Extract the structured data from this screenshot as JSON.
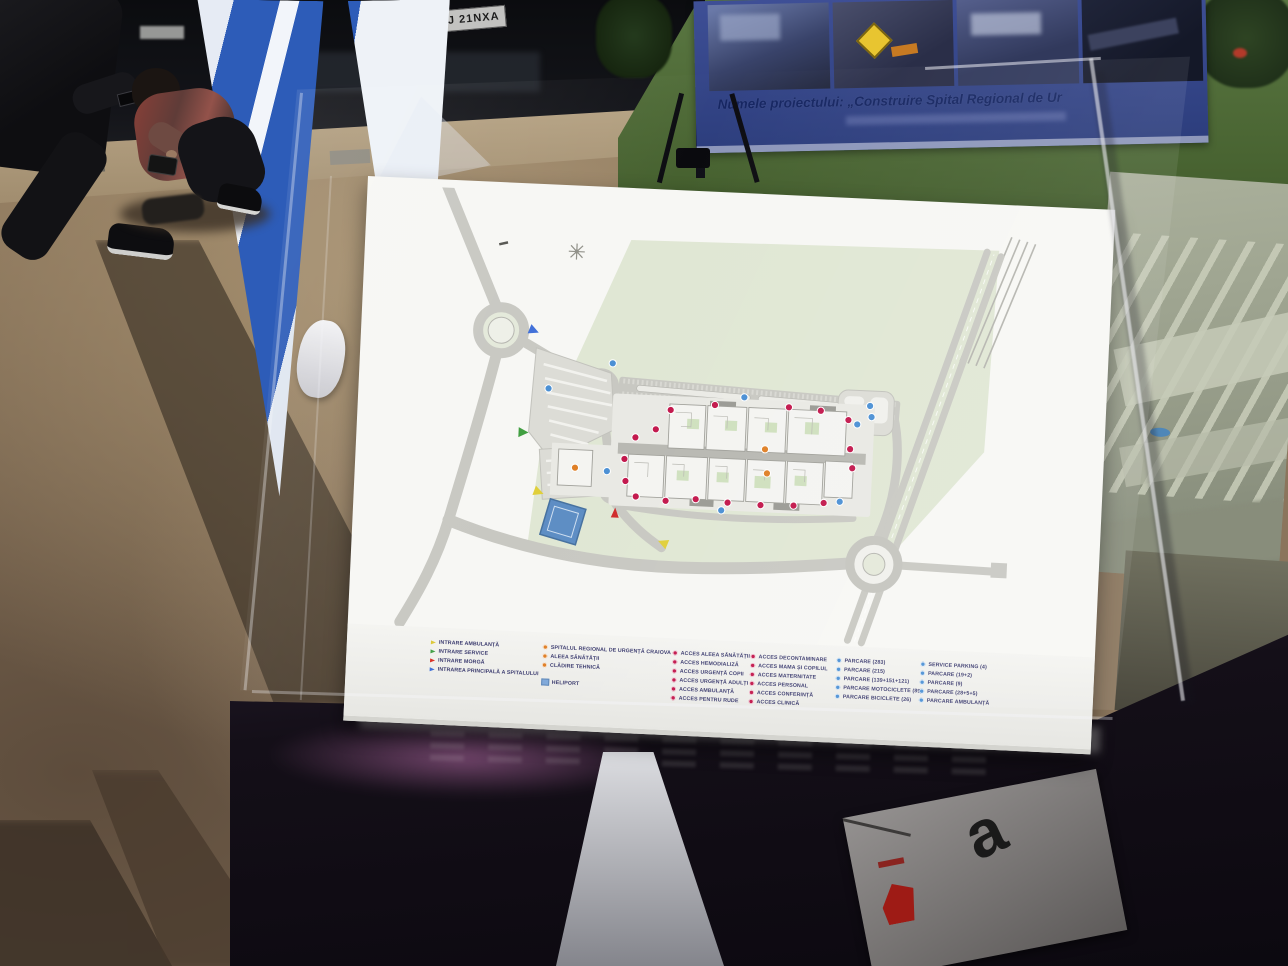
{
  "scene": {
    "truck": {
      "plate": "GJ 21NXA"
    },
    "banner": {
      "title": "Numele proiectului: „Construire Spital Regional de Ur"
    },
    "paper": {
      "letter": "a"
    }
  },
  "board": {
    "legend": {
      "entrances": [
        {
          "marker": "yellow-arrow",
          "label": "INTRARE AMBULANȚĂ"
        },
        {
          "marker": "green-arrow",
          "label": "INTRARE SERVICE"
        },
        {
          "marker": "red-arrow",
          "label": "INTRARE MORGĂ"
        },
        {
          "marker": "blue-arrow",
          "label": "INTRAREA PRINCIPALĂ A SPITALULUI"
        }
      ],
      "places": [
        {
          "marker": "orange-circle",
          "label": "SPITALUL REGIONAL DE URGENȚĂ CRAIOVA"
        },
        {
          "marker": "orange-circle",
          "label": "ALEEA SĂNĂTĂȚII"
        },
        {
          "marker": "orange-circle",
          "label": "CLĂDIRE TEHNICĂ"
        },
        {
          "marker": "blue-square",
          "label": "HELIPORT"
        }
      ],
      "access_a": [
        {
          "marker": "red-circle",
          "label": "ACCES ALEEA SĂNĂTĂȚII"
        },
        {
          "marker": "red-circle",
          "label": "ACCES HEMODIALIZĂ"
        },
        {
          "marker": "red-circle",
          "label": "ACCES URGENȚĂ COPII"
        },
        {
          "marker": "red-circle",
          "label": "ACCES URGENȚĂ ADULȚI"
        },
        {
          "marker": "red-circle",
          "label": "ACCES AMBULANȚĂ"
        },
        {
          "marker": "red-circle",
          "label": "ACCES PENTRU RUDE"
        }
      ],
      "access_b": [
        {
          "marker": "red-circle",
          "label": "ACCES DECONTAMINARE"
        },
        {
          "marker": "red-circle",
          "label": "ACCES MAMA ȘI COPILUL"
        },
        {
          "marker": "red-circle",
          "label": "ACCES MATERNITATE"
        },
        {
          "marker": "red-circle",
          "label": "ACCES PERSONAL"
        },
        {
          "marker": "red-circle",
          "label": "ACCES CONFERINȚĂ"
        },
        {
          "marker": "red-circle",
          "label": "ACCES CLINICĂ"
        }
      ],
      "parking_a": [
        {
          "marker": "blue-circle",
          "label": "PARCARE (283)"
        },
        {
          "marker": "blue-circle",
          "label": "PARCARE (215)"
        },
        {
          "marker": "blue-circle",
          "label": "PARCARE (139+151+121)"
        },
        {
          "marker": "blue-circle",
          "label": "PARCARE MOTOCICLETE (89)"
        },
        {
          "marker": "blue-circle",
          "label": "PARCARE BICICLETE (26)"
        }
      ],
      "parking_b": [
        {
          "marker": "blue-circle",
          "label": "SERVICE PARKING (4)"
        },
        {
          "marker": "blue-circle",
          "label": "PARCARE (19+2)"
        },
        {
          "marker": "blue-circle",
          "label": "PARCARE (9)"
        },
        {
          "marker": "blue-circle",
          "label": "PARCARE (28+5+5)"
        },
        {
          "marker": "blue-circle",
          "label": "PARCARE AMBULANȚĂ"
        }
      ]
    }
  },
  "colors": {
    "board_white": "#f7f7f4",
    "plan_green": "#e0e7d4",
    "road_gray": "#c8c8c2",
    "heliport_blue": "#5d8dc4",
    "marker_red": "#c2164b",
    "marker_blue": "#4a8fd4",
    "marker_orange": "#df7f26",
    "banner_blue": "#3e4f96",
    "flag_blue": "#2d5cb8",
    "dirt_brown": "#8a755c",
    "table_dark": "#140f18"
  }
}
